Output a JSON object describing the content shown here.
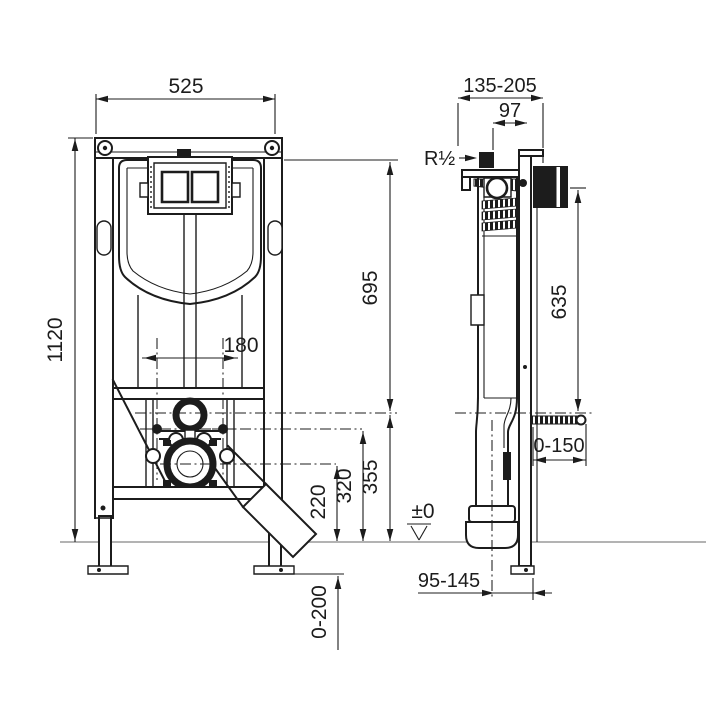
{
  "colors": {
    "line": "#1c1c1c",
    "floor_line": "#9a9a9a",
    "background": "#ffffff"
  },
  "front_view": {
    "dimensions": {
      "overall_width": "525",
      "overall_height": "1120",
      "wc_bolt_spacing": "180",
      "top_to_flush_axis": "695",
      "flush_axis_height": "355",
      "bolt_axis_height": "320",
      "drain_axis_height": "220",
      "foot_adjustment": "0-200"
    }
  },
  "side_view": {
    "dimensions": {
      "mounting_depth_range": "135-205",
      "inlet_setback": "97",
      "inlet_thread": "R½",
      "actuator_height": "635",
      "rod_projection": "0-150",
      "floor_level": "±0",
      "outlet_wall_distance": "95-145"
    }
  }
}
